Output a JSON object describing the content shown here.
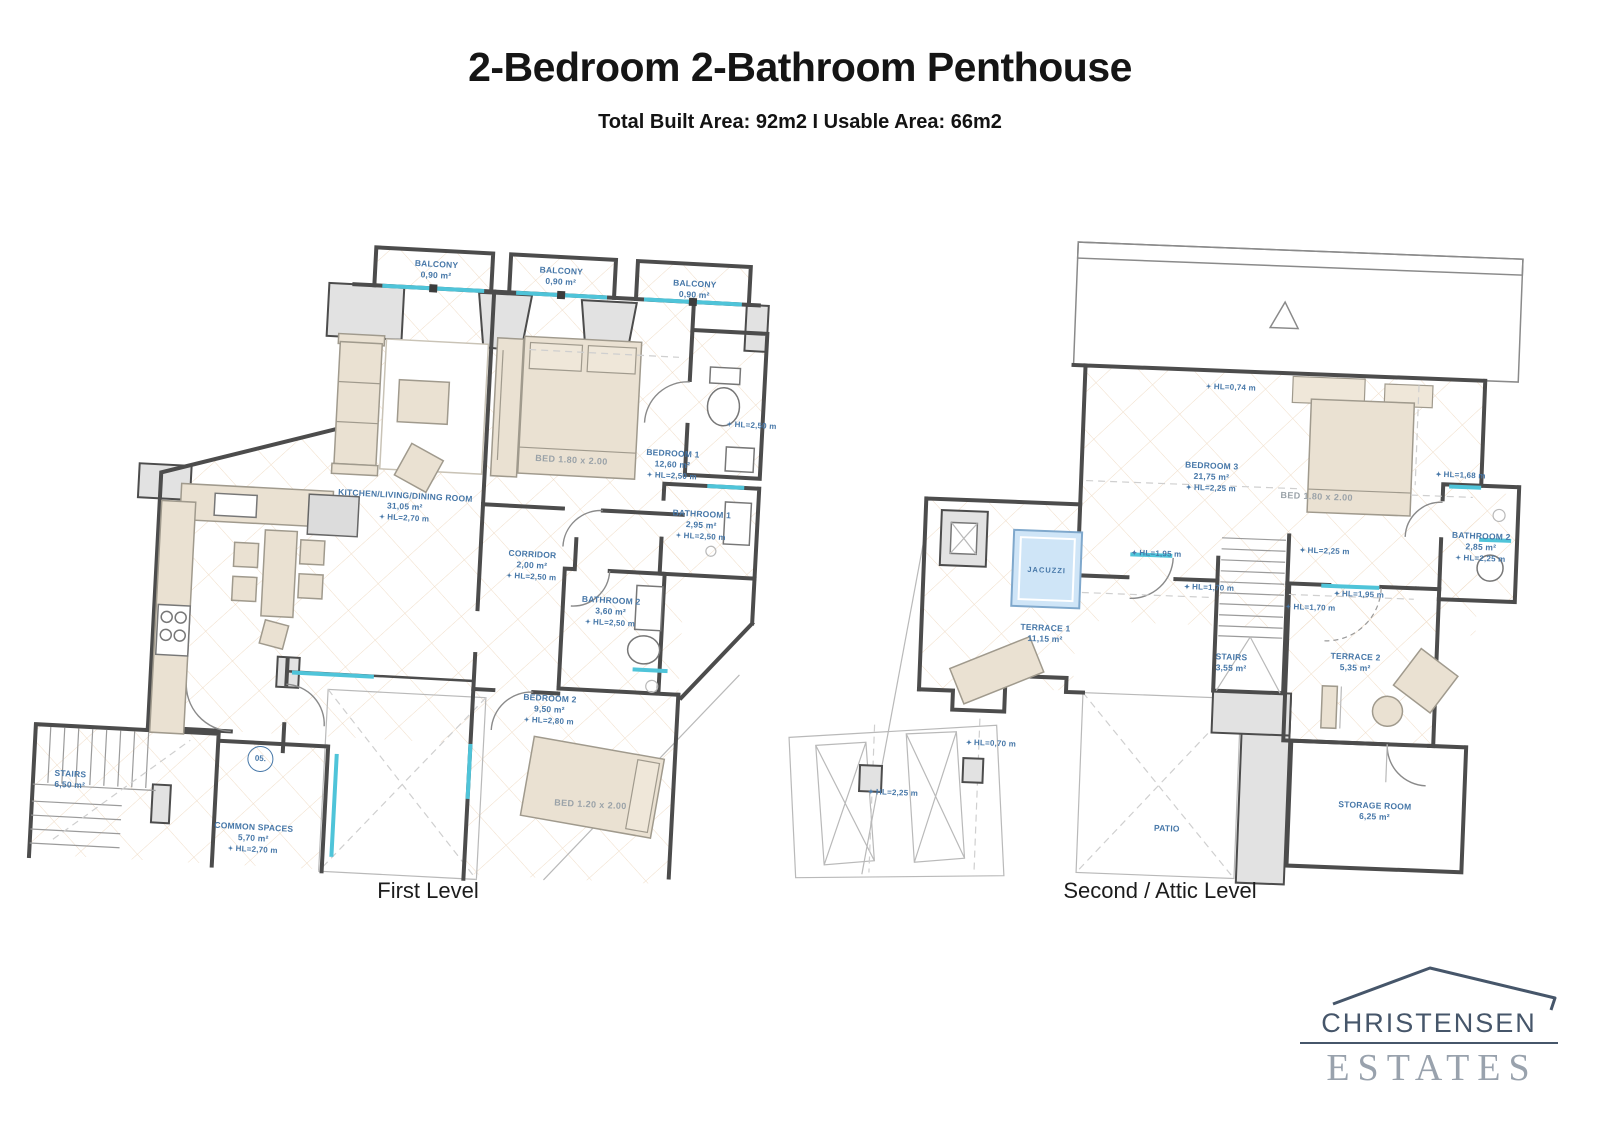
{
  "header": {
    "title": "2-Bedroom 2-Bathroom Penthouse",
    "subtitle": "Total Built Area: 92m2 I Usable Area: 66m2"
  },
  "icons": {
    "height_marker": "✦"
  },
  "plans": {
    "first": {
      "caption": "First Level",
      "unit_badge": "05.",
      "balcony1": {
        "name": "BALCONY",
        "area": "0,90 m²"
      },
      "balcony2": {
        "name": "BALCONY",
        "area": "0,90 m²"
      },
      "balcony3": {
        "name": "BALCONY",
        "area": "0,90 m²"
      },
      "kitchen": {
        "name": "KITCHEN/LIVING/DINING ROOM",
        "area": "31,05 m²",
        "hl": "HL=2,70 m"
      },
      "bedroom1": {
        "name": "BEDROOM 1",
        "area": "12,60 m²",
        "hl": "HL=2,50 m"
      },
      "bathroom1": {
        "name": "BATHROOM 1",
        "area": "2,95 m²",
        "hl": "HL=2,50 m"
      },
      "corridor": {
        "name": "CORRIDOR",
        "area": "2,00 m²",
        "hl": "HL=2,50 m"
      },
      "bathroom2": {
        "name": "BATHROOM 2",
        "area": "3,60 m²",
        "hl": "HL=2,50 m"
      },
      "bedroom2": {
        "name": "BEDROOM 2",
        "area": "9,50 m²",
        "hl": "HL=2,80 m"
      },
      "stairs": {
        "name": "STAIRS",
        "area": "6,50 m²"
      },
      "common": {
        "name": "COMMON SPACES",
        "area": "5,70 m²",
        "hl": "HL=2,70 m"
      },
      "bed1_label": "BED 1.80 x 2.00",
      "bed2_label": "BED 1.20 x 2.00",
      "wc_hl": "HL=2,50 m"
    },
    "second": {
      "caption": "Second / Attic Level",
      "bedroom3": {
        "name": "BEDROOM 3",
        "area": "21,75 m²",
        "hl": "HL=2,25 m"
      },
      "bathroom2": {
        "name": "BATHROOM 2",
        "area": "2,85 m²",
        "hl": "HL=2,25 m"
      },
      "terrace1": {
        "name": "TERRACE 1",
        "area": "11,15 m²"
      },
      "terrace2": {
        "name": "TERRACE 2",
        "area": "5,35 m²"
      },
      "stairs": {
        "name": "STAIRS",
        "area": "3,55 m²"
      },
      "storage": {
        "name": "STORAGE ROOM",
        "area": "6,25 m²"
      },
      "jacuzzi_label": "JACUZZI",
      "patio_label": "PATIO",
      "bed3_label": "BED 1.80 x 2.00",
      "hl_074": "HL=0,74 m",
      "hl_168": "HL=1,68 m",
      "hl_225_corridor": "HL=2,25 m",
      "hl_195_door": "HL=1,95 m",
      "hl_170_left": "HL=1,70 m",
      "hl_170_right": "HL=1,70 m",
      "hl_195_terrace2": "HL=1,95 m",
      "hl_070": "HL=0,70 m",
      "hl_225_bottom": "HL=2,25 m"
    }
  },
  "logo": {
    "line1": "CHRISTENSEN",
    "line2": "ESTATES"
  },
  "colors": {
    "label_blue": "#4677a8",
    "window_cyan": "#4fc4d9",
    "furniture_beige": "#eae1d2",
    "wall_gray": "#e2e2e2",
    "jacuzzi_blue": "#cfe5f7",
    "logo_dark": "#46566a",
    "logo_light": "#99a2ad"
  }
}
